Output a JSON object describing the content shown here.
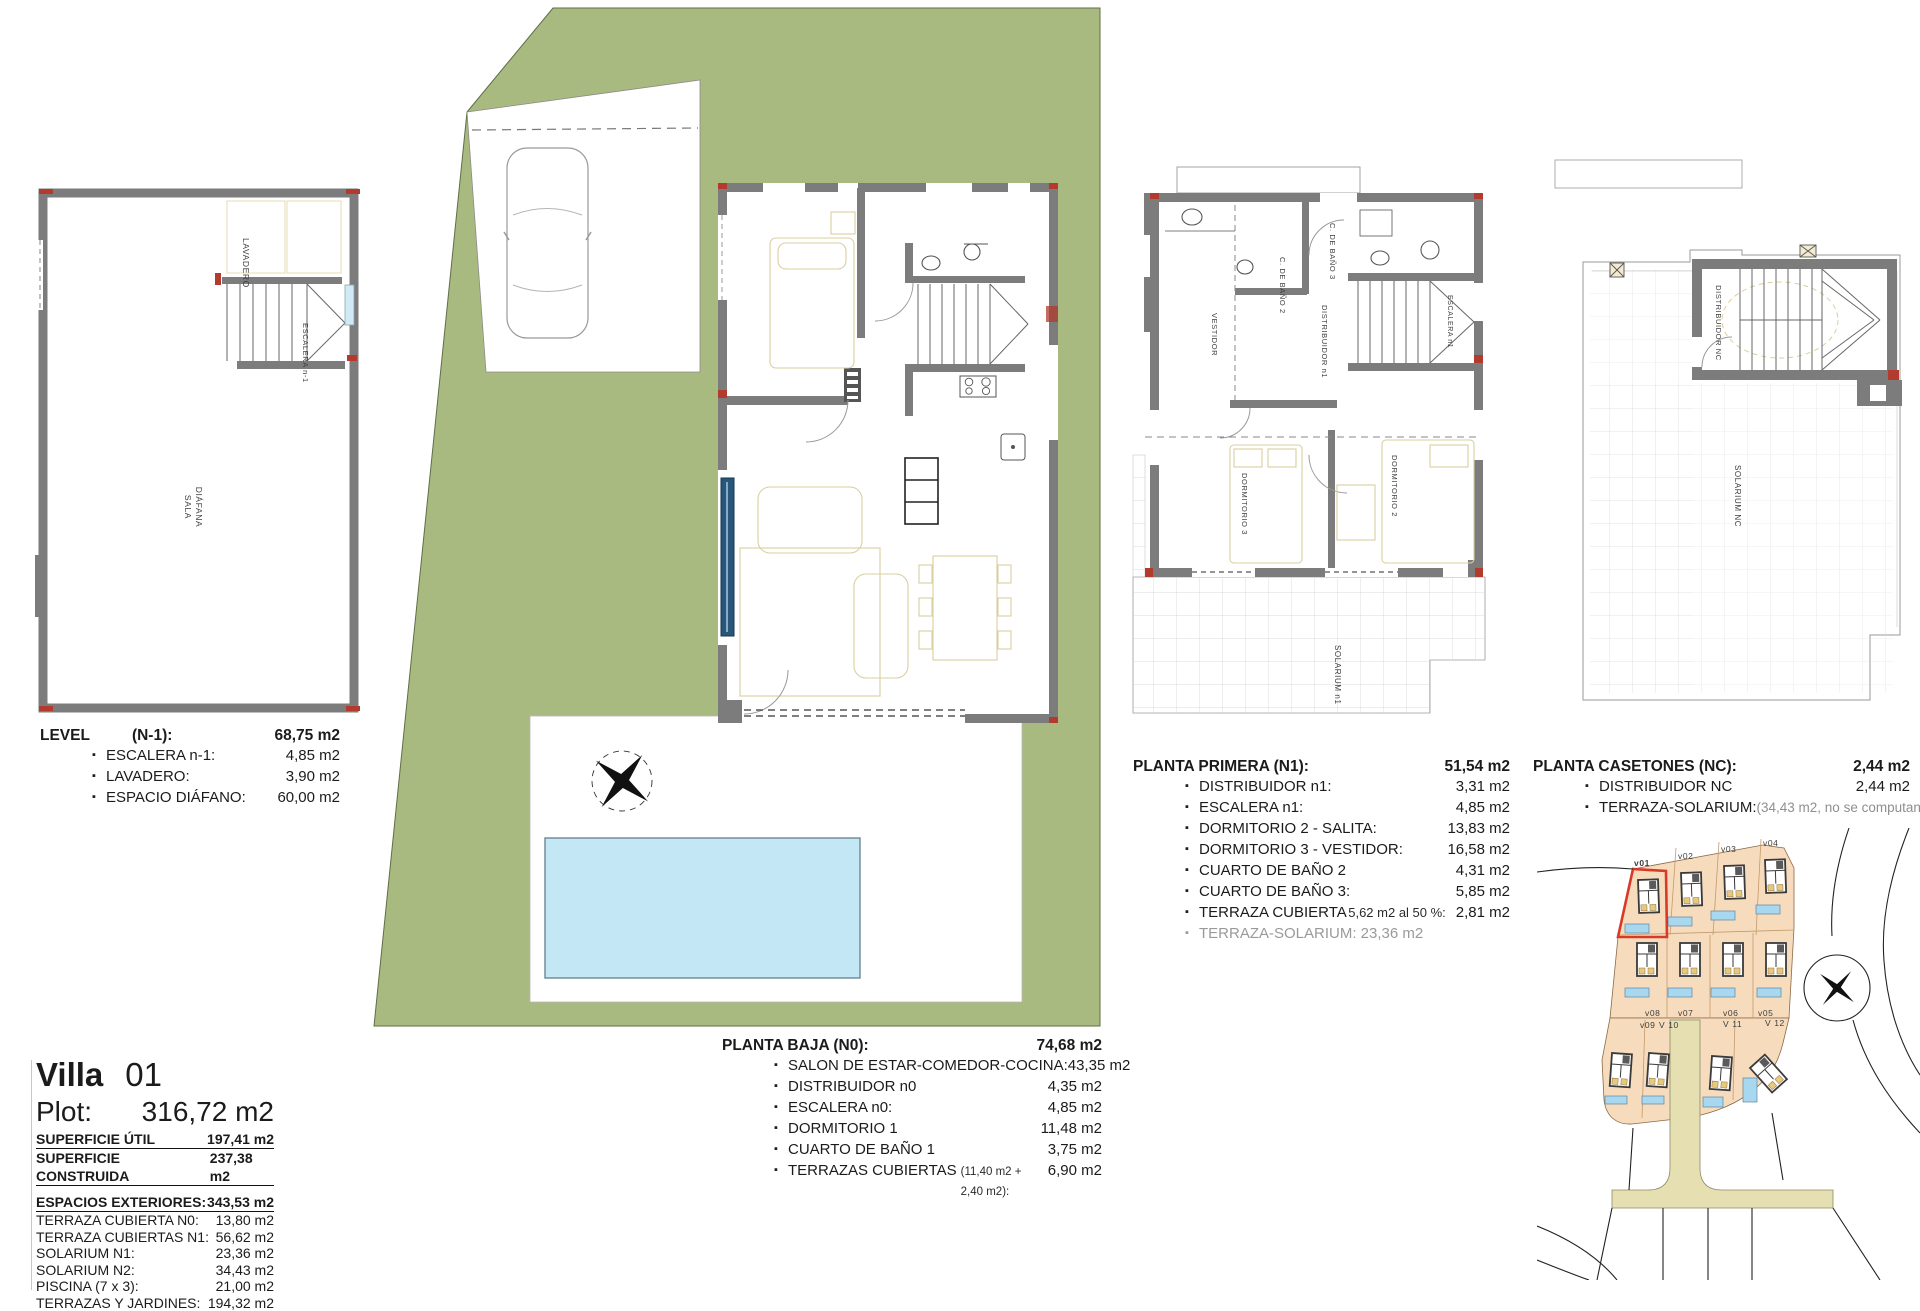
{
  "colors": {
    "plot_green": "#a8ba80",
    "pool_blue": "#c3e7f5",
    "parcel_peach": "#f6dcbd",
    "road_tan": "#e6dfb2",
    "wall_gray": "#7c7c7c",
    "accent_red": "#c0392b",
    "highlight_red": "#d93a28",
    "map_pool_blue": "#a8d8ef"
  },
  "left_plan": {
    "labels": {
      "lavadero": "LAVADERO",
      "escalera": "ESCALERA n-1",
      "sala_1": "SALA",
      "sala_2": "DIÁFANA"
    }
  },
  "level_n1": {
    "title": "LEVEL",
    "code": "(N-1):",
    "total": "68,75 m2",
    "items": [
      {
        "label": "ESCALERA n-1:",
        "value": "4,85 m2"
      },
      {
        "label": "LAVADERO:",
        "value": "3,90 m2"
      },
      {
        "label": "ESPACIO DIÁFANO:",
        "value": "60,00 m2"
      }
    ]
  },
  "n0_block": {
    "title": "PLANTA BAJA (N0):",
    "total": "74,68 m2",
    "items": [
      {
        "label": "SALON DE ESTAR-COMEDOR-COCINA:",
        "value": "43,35 m2"
      },
      {
        "label": "DISTRIBUIDOR n0",
        "value": "4,35 m2"
      },
      {
        "label": "ESCALERA n0:",
        "value": "4,85 m2"
      },
      {
        "label": "DORMITORIO 1",
        "value": "11,48 m2"
      },
      {
        "label": "CUARTO DE BAÑO 1",
        "value": "3,75 m2"
      },
      {
        "label": "TERRAZAS CUBIERTAS",
        "note": "(11,40 m2 + 2,40 m2):",
        "value": "6,90 m2"
      }
    ]
  },
  "n1_block": {
    "title": "PLANTA PRIMERA (N1):",
    "total": "51,54 m2",
    "items": [
      {
        "label": "DISTRIBUIDOR  n1:",
        "value": "3,31 m2"
      },
      {
        "label": "ESCALERA  n1:",
        "value": "4,85 m2"
      },
      {
        "label": "DORMITORIO  2 - SALITA:",
        "value": "13,83 m2"
      },
      {
        "label": "DORMITORIO 3 - VESTIDOR:",
        "value": "16,58 m2"
      },
      {
        "label": "CUARTO DE BAÑO 2",
        "value": "4,31 m2"
      },
      {
        "label": "CUARTO DE BAÑO 3:",
        "value": "5,85 m2"
      },
      {
        "label": "TERRAZA CUBIERTA",
        "note": "5,62 m2 al 50 %:",
        "value": "2,81 m2"
      },
      {
        "label": "TERRAZA-SOLARIUM:  23,36 m2",
        "value": ""
      }
    ]
  },
  "n1_plan": {
    "labels": {
      "bano3": "C. DE BAÑO 3",
      "bano2": "C. DE BAÑO 2",
      "vestidor": "VESTIDOR",
      "distribuidor": "DISTRIBUIDOR n1",
      "escalera": "ESCALERA n1",
      "dorm3": "DORMITORIO 3",
      "dorm2": "DORMITORIO 2",
      "solarium": "SOLARIUM n1"
    }
  },
  "nc_block": {
    "title": "PLANTA CASETONES (NC):",
    "total": "2,44 m2",
    "items": [
      {
        "label": "DISTRIBUIDOR NC",
        "value": "2,44 m2"
      },
      {
        "label": "TERRAZA-SOLARIUM:",
        "value": "(34,43 m2, no se computan"
      }
    ]
  },
  "nc_plan": {
    "labels": {
      "distribuidor": "DISTRIBUIDOR NC",
      "solarium": "SOLARIUM NC"
    }
  },
  "villa_info": {
    "name": "Villa",
    "number": "01",
    "plot_label": "Plot:",
    "plot_value": "316,72 m2",
    "surface_rows": [
      {
        "label": "SUPERFICIE ÚTIL",
        "value": "197,41 m2"
      },
      {
        "label": "SUPERFICIE CONSTRUIDA",
        "value": "237,38 m2"
      }
    ],
    "ext_title": "ESPACIOS EXTERIORES:",
    "ext_total": "343,53 m2",
    "ext_items": [
      {
        "label": "TERRAZA CUBIERTA N0:",
        "value": "13,80 m2"
      },
      {
        "label": "TERRAZA CUBIERTAS N1:",
        "value": "56,62 m2"
      },
      {
        "label": "SOLARIUM  N1:",
        "value": "23,36 m2"
      },
      {
        "label": "SOLARIUM  N2:",
        "value": "34,43 m2"
      },
      {
        "label": "PISCINA  (7 x 3):",
        "value": "21,00 m2"
      },
      {
        "label": "TERRAZAS Y JARDINES:",
        "value": "194,32 m2"
      }
    ]
  },
  "site_map": {
    "labels": [
      "v01",
      "v02",
      "v03",
      "v04",
      "v08",
      "v07",
      "v06",
      "v05",
      "v09",
      "V 10",
      "V 11",
      "V 12"
    ]
  }
}
